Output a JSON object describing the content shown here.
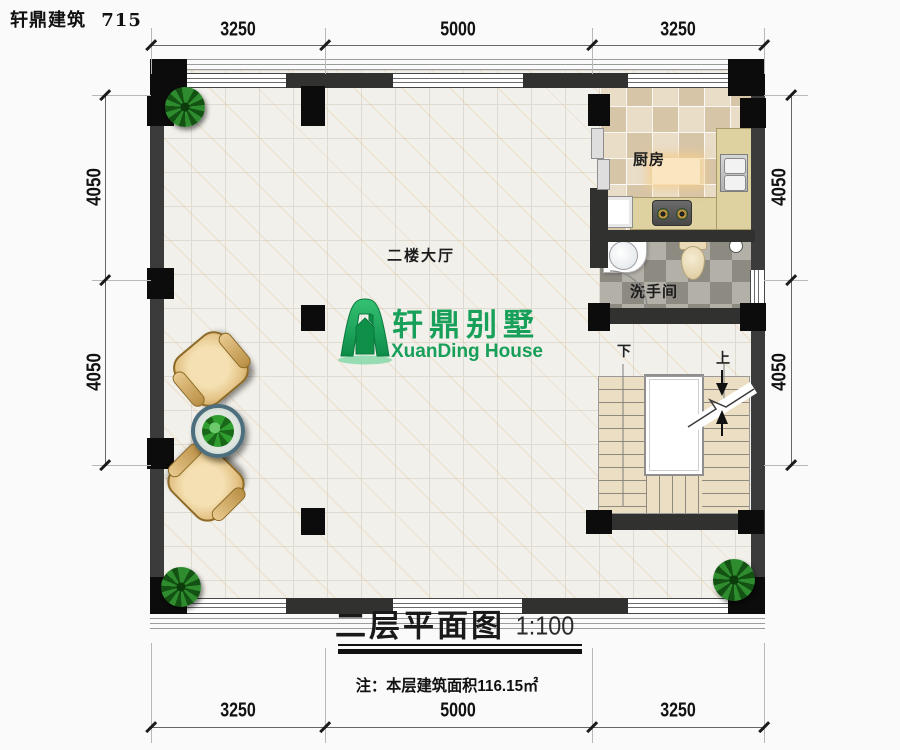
{
  "header": {
    "brand": "轩鼎建筑",
    "model": "715"
  },
  "rooms": {
    "hall": "二楼大厅",
    "kitchen": "厨房",
    "bathroom": "洗手间"
  },
  "stairs": {
    "down_label": "下",
    "up_label": "上"
  },
  "logo": {
    "cn": "轩鼎别墅",
    "en": "XuanDing House",
    "color": "#18a05a"
  },
  "title_block": {
    "title": "二层平面图",
    "scale": "1:100",
    "note": "注：本层建筑面积116.15㎡"
  },
  "dimensions": {
    "top": [
      "3250",
      "5000",
      "3250"
    ],
    "bottom": [
      "3250",
      "5000",
      "3250"
    ],
    "left": [
      "4050",
      "4050"
    ],
    "right": [
      "4050",
      "4050"
    ]
  },
  "colors": {
    "logo_green": "#18a05a",
    "wall_dark": "#31312f",
    "column_black": "#0c0c0c",
    "counter_khaki": "#ddd2a0",
    "stair_tan": "#ecdec2",
    "hall_tile": "#f2f0ea"
  }
}
